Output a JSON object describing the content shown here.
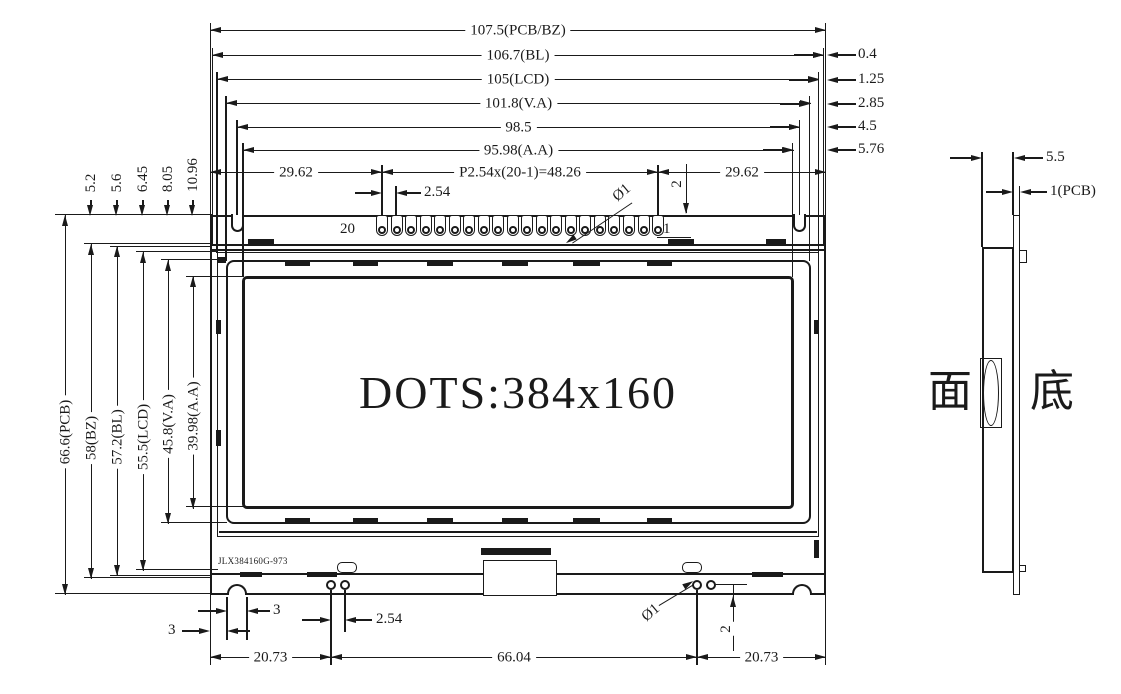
{
  "front_view": {
    "display_area_text": "DOTS:384x160",
    "part_number": "JLX384160G-973",
    "width_dims": [
      {
        "label": "107.5(PCB/BZ)"
      },
      {
        "label": "106.7(BL)"
      },
      {
        "label": "105(LCD)"
      },
      {
        "label": "101.8(V.A)"
      },
      {
        "label": "98.5"
      },
      {
        "label": "95.98(A.A)"
      }
    ],
    "right_edge_offsets": [
      {
        "label": "0.4"
      },
      {
        "label": "1.25"
      },
      {
        "label": "2.85"
      },
      {
        "label": "4.5"
      },
      {
        "label": "5.76"
      }
    ],
    "height_dims": [
      {
        "label": "66.6(PCB)"
      },
      {
        "label": "58(BZ)"
      },
      {
        "label": "57.2(BL)"
      },
      {
        "label": "55.5(LCD)"
      },
      {
        "label": "45.8(V.A)"
      },
      {
        "label": "39.98(A.A)"
      }
    ],
    "top_edge_offsets": [
      {
        "label": "5.2"
      },
      {
        "label": "5.6"
      },
      {
        "label": "6.45"
      },
      {
        "label": "8.05"
      },
      {
        "label": "10.96"
      }
    ],
    "pin_header": {
      "pin_count": 20,
      "last_pin_label": "20",
      "first_pin_label": "1",
      "left_margin": "29.62",
      "pitch_formula": "P2.54x(20-1)=48.26",
      "right_margin": "29.62",
      "pitch": "2.54",
      "hole_diameter": "Ø1",
      "row_offset": "2"
    },
    "bottom_dims": {
      "notch_offset": "3",
      "notch_width": "3",
      "pin_pitch": "2.54",
      "hole_diameter": "Ø1",
      "pin_edge_offset": "2",
      "left_span": "20.73",
      "center_span": "66.04",
      "right_span": "20.73"
    }
  },
  "side_view": {
    "total_thickness": "5.5",
    "pcb_thickness": "1(PCB)",
    "front_face_label": "面",
    "back_face_label": "底"
  }
}
